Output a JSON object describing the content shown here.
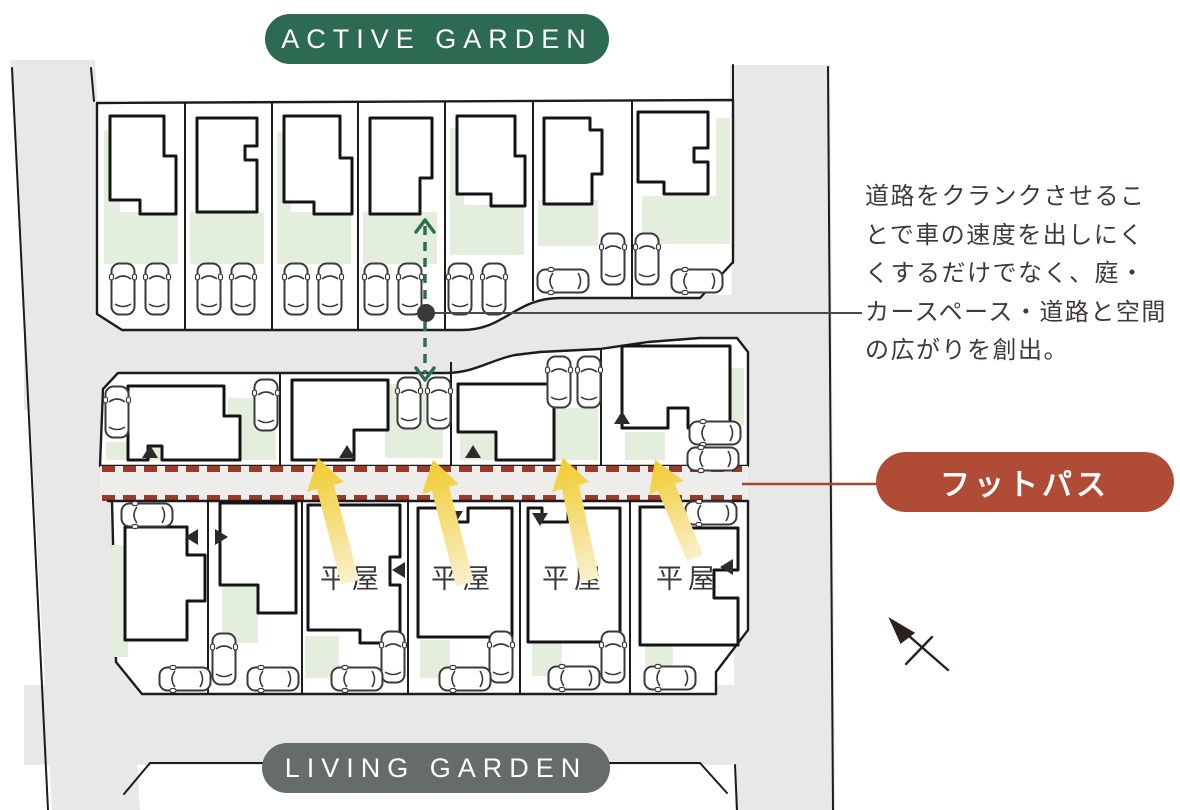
{
  "title_top": {
    "label": "ACTIVE GARDEN",
    "bg_color": "#2d6a52"
  },
  "title_bottom": {
    "label": "LIVING GARDEN",
    "bg_color": "#666c69"
  },
  "footpath": {
    "label": "フットパス",
    "bg_color": "#b04b36",
    "dash_color": "#993b28"
  },
  "annotation": {
    "lines": [
      "道路をクランクさせるこ",
      "とで車の速度を出しにく",
      "くするだけでなく、庭・",
      "カースペース・道路と空間",
      "の広がりを創出。"
    ],
    "text_color": "#3f3a37"
  },
  "plan": {
    "hiraya_labels": [
      "平屋",
      "平屋",
      "平屋",
      "平屋"
    ],
    "colors": {
      "road": "#e8e8e7",
      "footpath_strip": "#ededec",
      "garden_green": "#e4eedd",
      "arrow_yellow": "#f0cb2c",
      "arrow_yellow_tail": "#faf0cd",
      "crank_arrow_green": "#2f6e55",
      "outline_black": "#1c1c1c"
    }
  }
}
